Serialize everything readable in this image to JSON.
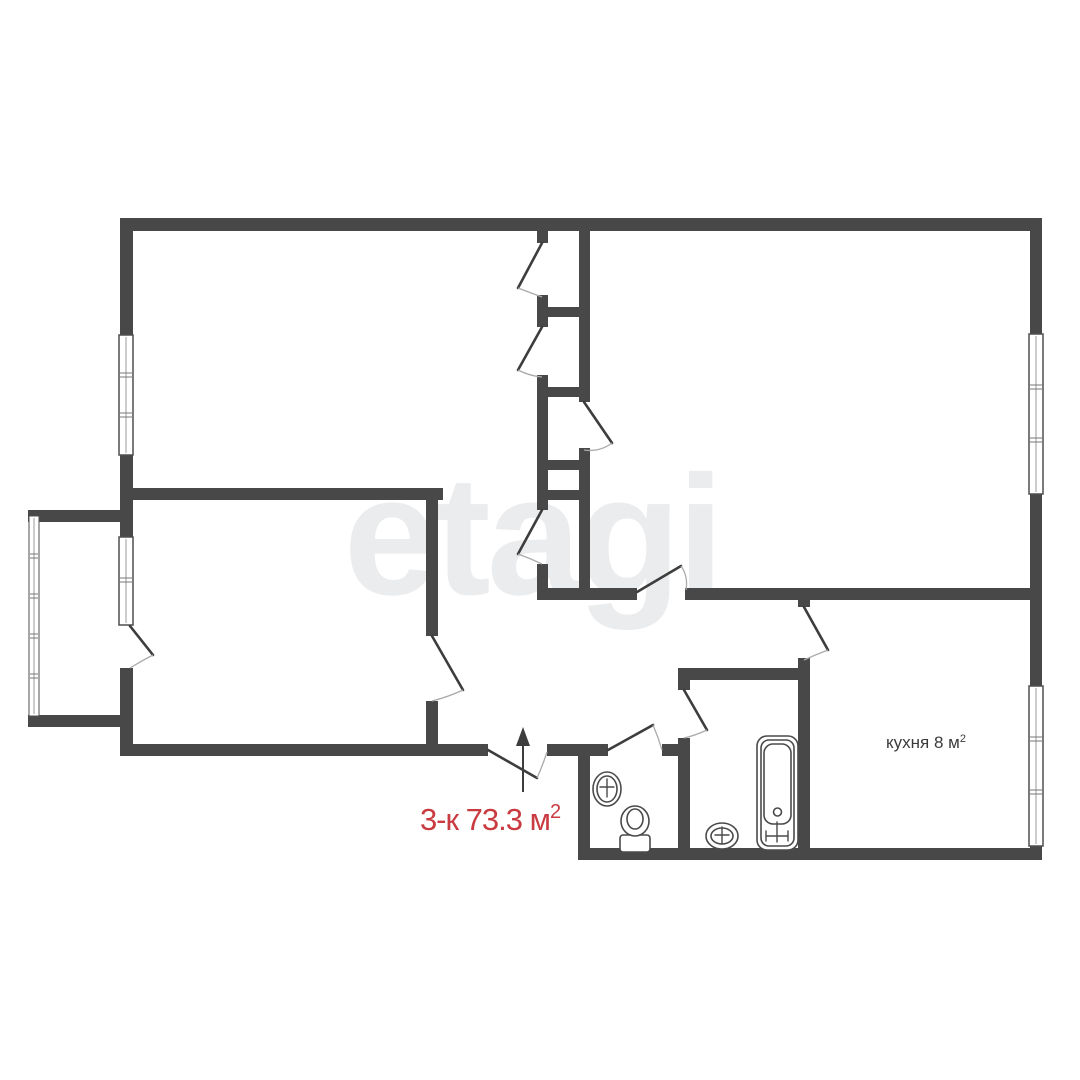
{
  "canvas": {
    "w": 1080,
    "h": 1080,
    "bg": "#ffffff"
  },
  "watermark": {
    "text": "etagi",
    "color": "#eaecee"
  },
  "colors": {
    "wall": "#484848",
    "door_leaf": "#3d3d3d",
    "door_arc": "#aaaaaa",
    "window_border": "#4f4f4f",
    "window_center": "#999999",
    "window_tick": "#777777",
    "fixture": "#4a4a4a",
    "arrow": "#3d3d3d"
  },
  "labels": {
    "kitchen": {
      "text": "кухня 8 м",
      "sup": "2"
    },
    "area": {
      "text": "3-к 73.3 м",
      "sup": "2"
    }
  },
  "plan": {
    "walls": [
      {
        "n": "outer-wall-top",
        "x": 120,
        "y": 218,
        "w": 922,
        "h": 13
      },
      {
        "n": "outer-wall-right-upper",
        "x": 1030,
        "y": 231,
        "w": 12,
        "h": 103
      },
      {
        "n": "outer-wall-right-mid",
        "x": 1030,
        "y": 494,
        "w": 12,
        "h": 192
      },
      {
        "n": "outer-wall-right-lower",
        "x": 1030,
        "y": 846,
        "w": 12,
        "h": 14
      },
      {
        "n": "kitchen-bottom-wall",
        "x": 578,
        "y": 848,
        "w": 464,
        "h": 12
      },
      {
        "n": "outer-wall-left-upper",
        "x": 120,
        "y": 231,
        "w": 13,
        "h": 104
      },
      {
        "n": "outer-wall-left-mid",
        "x": 120,
        "y": 455,
        "w": 13,
        "h": 82
      },
      {
        "n": "outer-wall-left-lower",
        "x": 120,
        "y": 668,
        "w": 13,
        "h": 88
      },
      {
        "n": "balcony-top-wall",
        "x": 28,
        "y": 510,
        "w": 92,
        "h": 12
      },
      {
        "n": "balcony-bottom-wall",
        "x": 28,
        "y": 715,
        "w": 92,
        "h": 12
      },
      {
        "n": "room3-bottom-wall",
        "x": 120,
        "y": 488,
        "w": 323,
        "h": 12
      },
      {
        "n": "room1-right-wall-upper",
        "x": 426,
        "y": 500,
        "w": 12,
        "h": 136
      },
      {
        "n": "room1-right-wall-lower",
        "x": 426,
        "y": 701,
        "w": 12,
        "h": 55
      },
      {
        "n": "bottom-wall-left",
        "x": 120,
        "y": 744,
        "w": 368,
        "h": 12
      },
      {
        "n": "bottom-wall-mid",
        "x": 547,
        "y": 744,
        "w": 61,
        "h": 12
      },
      {
        "n": "bottom-wall-right",
        "x": 662,
        "y": 744,
        "w": 28,
        "h": 12
      },
      {
        "n": "toilet-left-wall",
        "x": 578,
        "y": 756,
        "w": 12,
        "h": 92
      },
      {
        "n": "bathroom-top-wall",
        "x": 678,
        "y": 668,
        "w": 120,
        "h": 12
      },
      {
        "n": "bathroom-divider-stub",
        "x": 678,
        "y": 680,
        "w": 12,
        "h": 10
      },
      {
        "n": "bathroom-divider-wall",
        "x": 678,
        "y": 738,
        "w": 12,
        "h": 110
      },
      {
        "n": "kitchen-left-stub",
        "x": 798,
        "y": 598,
        "w": 12,
        "h": 9
      },
      {
        "n": "kitchen-left-wall",
        "x": 798,
        "y": 658,
        "w": 12,
        "h": 202
      },
      {
        "n": "hall-bottom-wall-a",
        "x": 537,
        "y": 588,
        "w": 100,
        "h": 12
      },
      {
        "n": "hall-bottom-wall-b",
        "x": 685,
        "y": 588,
        "w": 345,
        "h": 12
      },
      {
        "n": "closet-left-stub-1",
        "x": 537,
        "y": 231,
        "w": 11,
        "h": 12
      },
      {
        "n": "closet-left-stub-2",
        "x": 537,
        "y": 295,
        "w": 11,
        "h": 32
      },
      {
        "n": "closet-left-wall",
        "x": 537,
        "y": 375,
        "w": 11,
        "h": 135
      },
      {
        "n": "closet-left-stub-3",
        "x": 537,
        "y": 564,
        "w": 11,
        "h": 33
      },
      {
        "n": "closet-right-wall-upper",
        "x": 579,
        "y": 231,
        "w": 11,
        "h": 171
      },
      {
        "n": "closet-right-wall-lower",
        "x": 579,
        "y": 448,
        "w": 11,
        "h": 149
      },
      {
        "n": "closet-shelf-1",
        "x": 537,
        "y": 307,
        "w": 53,
        "h": 10
      },
      {
        "n": "closet-shelf-2",
        "x": 537,
        "y": 387,
        "w": 53,
        "h": 10
      },
      {
        "n": "closet-shelf-3",
        "x": 537,
        "y": 460,
        "w": 53,
        "h": 10
      },
      {
        "n": "closet-shelf-4",
        "x": 537,
        "y": 490,
        "w": 53,
        "h": 10
      }
    ],
    "windows": [
      {
        "n": "window-room3-left",
        "x": 119,
        "y": 335,
        "w": 14,
        "h": 120,
        "ticks": [
          375,
          415
        ]
      },
      {
        "n": "window-room1-left",
        "x": 119,
        "y": 537,
        "w": 14,
        "h": 88,
        "ticks": [
          580
        ]
      },
      {
        "n": "window-room2-right",
        "x": 1029,
        "y": 334,
        "w": 14,
        "h": 160,
        "ticks": [
          387,
          440
        ]
      },
      {
        "n": "window-kitchen-right",
        "x": 1029,
        "y": 686,
        "w": 14,
        "h": 160,
        "ticks": [
          739,
          792
        ]
      },
      {
        "n": "balcony-glazing",
        "x": 29,
        "y": 516,
        "w": 10,
        "h": 200,
        "ticks": [
          556,
          596,
          636,
          676
        ],
        "thin": true
      }
    ],
    "doors": [
      {
        "n": "closet-door-1",
        "h": [
          542,
          243
        ],
        "t": [
          518,
          288
        ],
        "w": [
          542,
          297
        ]
      },
      {
        "n": "closet-door-2",
        "h": [
          542,
          327
        ],
        "t": [
          518,
          370
        ],
        "w": [
          542,
          377
        ]
      },
      {
        "n": "closet-door-3",
        "h": [
          584,
          402
        ],
        "t": [
          612,
          443
        ],
        "w": [
          584,
          450
        ]
      },
      {
        "n": "closet-door-4",
        "h": [
          542,
          510
        ],
        "t": [
          518,
          554
        ],
        "w": [
          542,
          564
        ]
      },
      {
        "n": "room2-door",
        "h": [
          637,
          592
        ],
        "t": [
          681,
          566
        ],
        "w": [
          686,
          590
        ]
      },
      {
        "n": "kitchen-door",
        "h": [
          804,
          607
        ],
        "t": [
          828,
          650
        ],
        "w": [
          804,
          660
        ]
      },
      {
        "n": "bathroom-door",
        "h": [
          684,
          690
        ],
        "t": [
          707,
          730
        ],
        "w": [
          684,
          738
        ]
      },
      {
        "n": "toilet-door",
        "h": [
          608,
          750
        ],
        "t": [
          653,
          725
        ],
        "w": [
          662,
          750
        ]
      },
      {
        "n": "room1-door",
        "h": [
          432,
          636
        ],
        "t": [
          463,
          690
        ],
        "w": [
          432,
          701
        ]
      },
      {
        "n": "balcony-door",
        "h": [
          130,
          626
        ],
        "t": [
          153,
          655
        ],
        "w": [
          130,
          668
        ]
      },
      {
        "n": "entrance-door",
        "h": [
          488,
          750
        ],
        "t": [
          537,
          778
        ],
        "w": [
          547,
          752
        ]
      }
    ],
    "arrow": {
      "n": "entrance-arrow",
      "shaft": [
        523,
        792,
        523,
        746
      ],
      "head": [
        [
          523,
          727
        ],
        [
          516,
          746
        ],
        [
          530,
          746
        ]
      ]
    },
    "fixtures": [
      {
        "n": "toilet-sink",
        "type": "ellipse",
        "cx": 607,
        "cy": 789,
        "rx": 14,
        "ry": 17
      },
      {
        "n": "toilet-sink-inner",
        "type": "ellipse",
        "cx": 607,
        "cy": 789,
        "rx": 10,
        "ry": 13
      },
      {
        "n": "toilet-sink-tap-v",
        "type": "line",
        "x1": 607,
        "y1": 779,
        "x2": 607,
        "y2": 797
      },
      {
        "n": "toilet-sink-tap-h",
        "type": "line",
        "x1": 600,
        "y1": 787,
        "x2": 614,
        "y2": 787
      },
      {
        "n": "toilet-tank",
        "type": "rect",
        "x": 620,
        "y": 835,
        "w": 30,
        "h": 17,
        "rx": 3
      },
      {
        "n": "toilet-bowl",
        "type": "ellipse",
        "cx": 635,
        "cy": 821,
        "rx": 14,
        "ry": 15
      },
      {
        "n": "toilet-bowl-inner",
        "type": "ellipse",
        "cx": 635,
        "cy": 819,
        "rx": 8,
        "ry": 10
      },
      {
        "n": "bathroom-sink",
        "type": "ellipse",
        "cx": 722,
        "cy": 836,
        "rx": 16,
        "ry": 13
      },
      {
        "n": "bathroom-sink-inner",
        "type": "ellipse",
        "cx": 722,
        "cy": 836,
        "rx": 11,
        "ry": 8
      },
      {
        "n": "bathroom-sink-tap-v",
        "type": "line",
        "x1": 722,
        "y1": 827,
        "x2": 722,
        "y2": 844
      },
      {
        "n": "bathroom-sink-tap-h",
        "type": "line",
        "x1": 715,
        "y1": 835,
        "x2": 729,
        "y2": 835
      },
      {
        "n": "bathtub-outer",
        "type": "rect",
        "x": 757,
        "y": 736,
        "w": 41,
        "h": 114,
        "rx": 10
      },
      {
        "n": "bathtub-mid",
        "type": "rect",
        "x": 761,
        "y": 740,
        "w": 33,
        "h": 106,
        "rx": 8
      },
      {
        "n": "bathtub-basin",
        "type": "rect",
        "x": 764,
        "y": 744,
        "w": 27,
        "h": 80,
        "rx": 9
      },
      {
        "n": "bathtub-drain",
        "type": "circle",
        "cx": 777.5,
        "cy": 812,
        "r": 4
      },
      {
        "n": "bathtub-tap-v",
        "type": "line",
        "x1": 777,
        "y1": 822,
        "x2": 777,
        "y2": 842
      },
      {
        "n": "bathtub-tap-h",
        "type": "line",
        "x1": 766,
        "y1": 836,
        "x2": 788,
        "y2": 836
      },
      {
        "n": "bathtub-tap-l",
        "type": "line",
        "x1": 766,
        "y1": 831,
        "x2": 766,
        "y2": 841
      },
      {
        "n": "bathtub-tap-r",
        "type": "line",
        "x1": 788,
        "y1": 831,
        "x2": 788,
        "y2": 841
      }
    ]
  }
}
